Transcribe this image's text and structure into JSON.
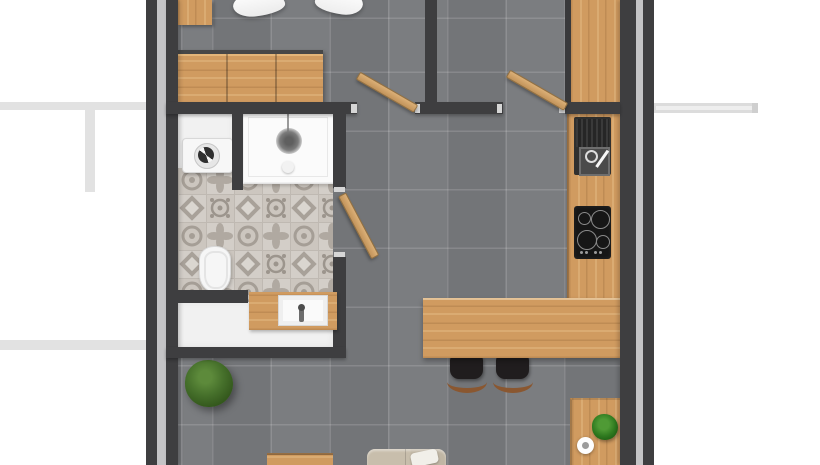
{
  "meta": {
    "type": "floor-plan",
    "view": "top-down-3d-render",
    "unit_label": "Studio apartment floor plan"
  },
  "palette": {
    "bg": "#ffffff",
    "wall": "#3e3e40",
    "wallGap": "#c4c4c6",
    "neighbor": "#e2e2e2",
    "floor": "#77797c",
    "wood": "#d09b60",
    "bathWhite": "#f1f1f1",
    "patternBase": "#d3cec8",
    "patternMotif": "#a59e96",
    "applianceBlack": "#161616",
    "stoolSeat": "#201d1e",
    "stoolBase": "#8a5730",
    "sofa": "#c3b9a8",
    "plantDark": "#33571c",
    "plantLight": "#5d8a3b"
  },
  "rooms": {
    "bedroom": {
      "label": "Bedroom"
    },
    "hall": {
      "label": "Entry hall"
    },
    "bathroom": {
      "label": "Bathroom"
    },
    "living": {
      "label": "Living room with kitchen"
    }
  },
  "fixtures": {
    "bed": {
      "label": "Bed with duvet (partially visible)"
    },
    "nightstand": {
      "label": "Nightstand"
    },
    "dresser": {
      "label": "Wooden dresser"
    },
    "wardrobe": {
      "label": "Tall cabinet"
    },
    "kitchen_counter": {
      "label": "Kitchen counter"
    },
    "kitchen_sink": {
      "label": "Kitchen sink with faucet"
    },
    "cooktop": {
      "label": "Cooktop with 4 burners"
    },
    "breakfast_bar": {
      "label": "Breakfast bar"
    },
    "bar_stool_1": {
      "label": "Bar stool"
    },
    "bar_stool_2": {
      "label": "Bar stool"
    },
    "side_table": {
      "label": "Side table"
    },
    "small_plant": {
      "label": "Small potted plant"
    },
    "cup": {
      "label": "Cup"
    },
    "large_plant": {
      "label": "Large potted plant"
    },
    "sofa": {
      "label": "Sofa (partially visible)"
    },
    "low_table": {
      "label": "Low wooden table (partially visible)"
    },
    "washing_machine": {
      "label": "Washing machine"
    },
    "shower": {
      "label": "Walk-in shower"
    },
    "toilet": {
      "label": "Toilet"
    },
    "vanity_sink": {
      "label": "Vanity with washbasin"
    },
    "door_bedroom": {
      "label": "Bedroom door"
    },
    "door_hall": {
      "label": "Hall door"
    },
    "door_bathroom": {
      "label": "Bathroom door"
    }
  }
}
